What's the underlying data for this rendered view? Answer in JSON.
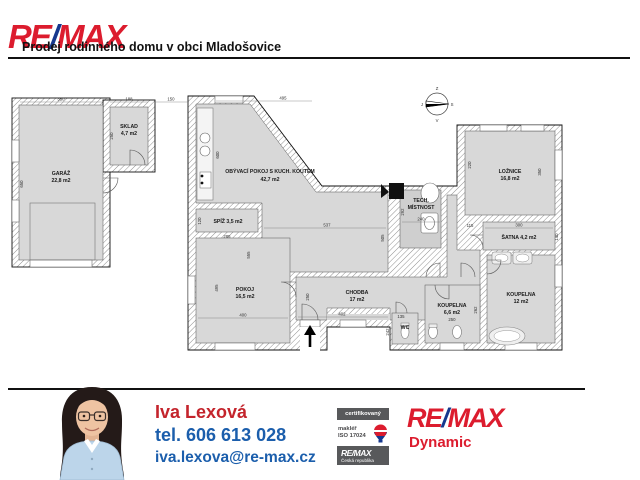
{
  "header": {
    "logo_re": "RE",
    "logo_slash": "/",
    "logo_max": "MAX",
    "title": "Prodej rodinného domu v obci Mladošovice"
  },
  "plan": {
    "compass": {
      "top": "Z",
      "right": "S",
      "bottom": "V",
      "left": "J"
    },
    "rooms": {
      "garaz": {
        "name": "GARÁŽ",
        "area": "22,8 m2"
      },
      "sklad": {
        "name": "SKLAD",
        "area": "4,7 m2"
      },
      "obyvaci": {
        "name": "OBÝVACÍ POKOJ S KUCH. KOUTEM",
        "area": "42,7 m2"
      },
      "spiz": {
        "name": "SPÍŽ 3,5 m2"
      },
      "pokoj": {
        "name": "POKOJ",
        "area": "16,5 m2"
      },
      "chodba": {
        "name": "CHODBA",
        "area": "17 m2"
      },
      "tech": {
        "name": "TECH.",
        "name2": "MÍSTNOST"
      },
      "loznice": {
        "name": "LOŽNICE",
        "area": "16,8 m2"
      },
      "satna": {
        "name": "ŠATNA 4,2 m2"
      },
      "koupelna_mala": {
        "name": "KOUPELNA",
        "area": "6,6 m2"
      },
      "koupelna_velka": {
        "name": "KOUPELNA",
        "area": "12 m2"
      },
      "wc": {
        "name": "WC"
      }
    },
    "dims": {
      "garaz_w": "350",
      "garaz_h": "650",
      "sklad_w": "188",
      "sklad_h": "250",
      "gap": "150",
      "obyvaci_w": "495",
      "obyvaci_h": "600",
      "obyvaci_iw": "537",
      "obyvaci_ih": "505",
      "spiz_w": "285",
      "spiz_h": "120",
      "pokoj_w": "400",
      "pokoj_h": "495",
      "pokoj_ih": "555",
      "chodba_w": "402",
      "chodba_h": "250",
      "tech_w": "240",
      "tech_h": "292",
      "satna_lh": "115",
      "satna_w": "300",
      "satna_rh": "140",
      "loznice_lh": "220",
      "loznice_rh": "350",
      "wc_w": "135",
      "wc_h": "242",
      "koupelna_mala_w": "250",
      "koupelna_mala_h": "262"
    }
  },
  "footer": {
    "agent": {
      "name": "Iva Lexová",
      "phone": "tel. 606 613 028",
      "email": "iva.lexova@re-max.cz"
    },
    "cert": {
      "row1": "certifikovaný",
      "row2a": "makléř",
      "row2b": "ISO 17024",
      "row3a": "RE/MAX",
      "row3b": "Česká republika"
    },
    "brand": {
      "re": "RE",
      "slash": "/",
      "max": "MAX",
      "office": "Dynamic"
    }
  },
  "colors": {
    "remax_red": "#dc1c2e",
    "remax_blue": "#16388e",
    "contact_blue": "#1b5eac",
    "badge_gray": "#58595b",
    "floor_gray": "#d8d8d8"
  }
}
